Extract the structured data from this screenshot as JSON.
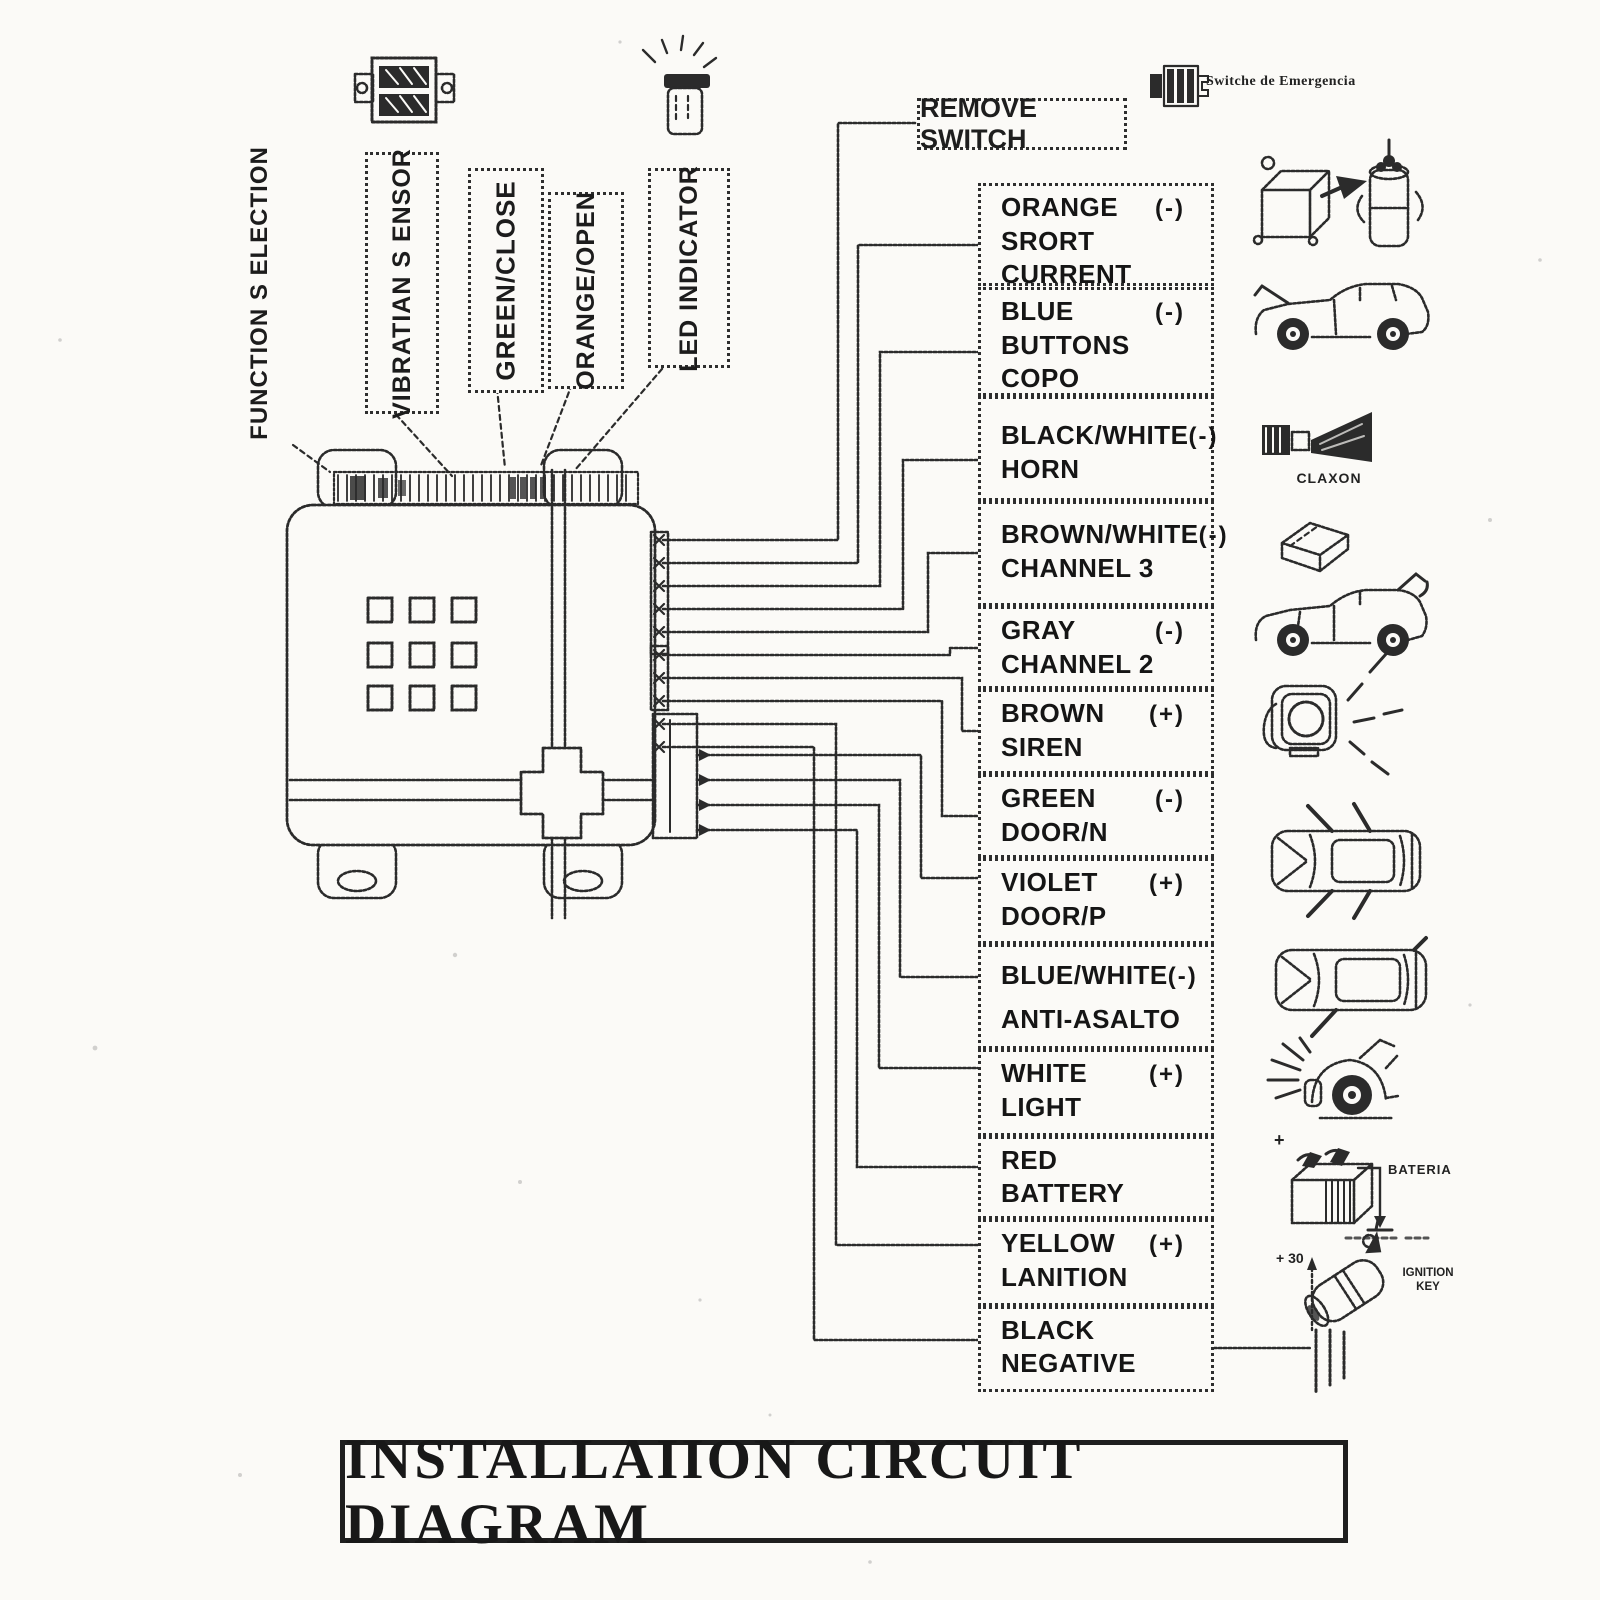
{
  "page": {
    "title": "INSTALLAIION CIRCUIT DIAGRAM"
  },
  "labels": {
    "function_selection": "FUNCTION S ELECTION",
    "vibration_sensor": "VIBRATIAN S ENSOR",
    "green_close": "GREEN/CLOSE",
    "orange_open": "ORANGE/OPEN",
    "led_indicator": "LED INDICATOR",
    "remove_switch": "REMOVE SWITCH",
    "emergency_switch": "Switche de Emergencia"
  },
  "wires": [
    {
      "color": "ORANGE",
      "polarity": "(-)",
      "func": "SRORT\nCURRENT"
    },
    {
      "color": "BLUE",
      "polarity": "(-)",
      "func": "BUTTONS\nCOPO"
    },
    {
      "color": "BLACK/WHITE",
      "polarity": "(-)",
      "func": "HORN"
    },
    {
      "color": "BROWN/WHITE",
      "polarity": "(-)",
      "func": "CHANNEL 3"
    },
    {
      "color": "GRAY",
      "polarity": "(-)",
      "func": "CHANNEL 2"
    },
    {
      "color": "BROWN",
      "polarity": "(+)",
      "func": "SIREN"
    },
    {
      "color": "GREEN",
      "polarity": "(-)",
      "func": "DOOR/N"
    },
    {
      "color": "VIOLET",
      "polarity": "(+)",
      "func": "DOOR/P"
    },
    {
      "color": "BLUE/WHITE",
      "polarity": "(-)",
      "func": "ANTI-ASALTO"
    },
    {
      "color": "WHITE",
      "polarity": "(+)",
      "func": "LIGHT"
    },
    {
      "color": "RED",
      "polarity": "",
      "func": "BATTERY"
    },
    {
      "color": "YELLOW",
      "polarity": "(+)",
      "func": "LANITION"
    },
    {
      "color": "BLACK",
      "polarity": "",
      "func": "NEGATIVE"
    }
  ],
  "icons": {
    "claxon": "CLAXON",
    "battery": "BATERIA",
    "battery_plus": "+",
    "ignition_plus": "+ 30",
    "ignition_key": "IGNITION\nKEY"
  },
  "colors": {
    "ink": "#2b2b2b",
    "paper": "#fbfaf7"
  }
}
